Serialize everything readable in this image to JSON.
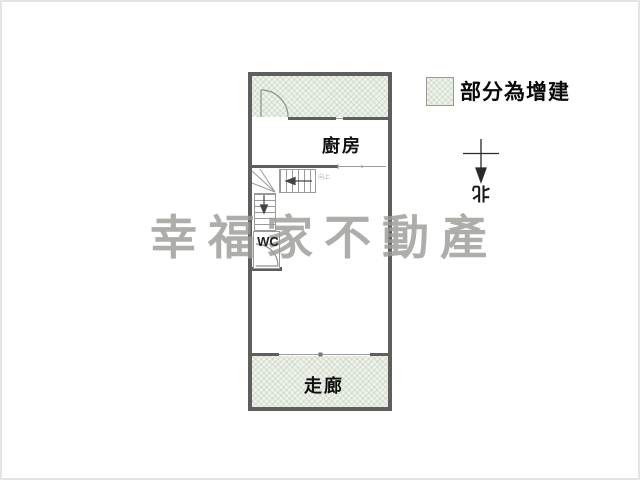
{
  "legend": {
    "label": "部分為增建"
  },
  "compass": {
    "north_label": "北"
  },
  "watermark": {
    "text": "幸福家不動產"
  },
  "floorplan": {
    "kitchen_label": "廚房",
    "wc_label": "WC",
    "corridor_label": "走廊",
    "stairs_note": "向上"
  },
  "colors": {
    "extension_fill": "#eef2e9",
    "wall": "#5e5e5e",
    "watermark": "#9c9c98"
  }
}
